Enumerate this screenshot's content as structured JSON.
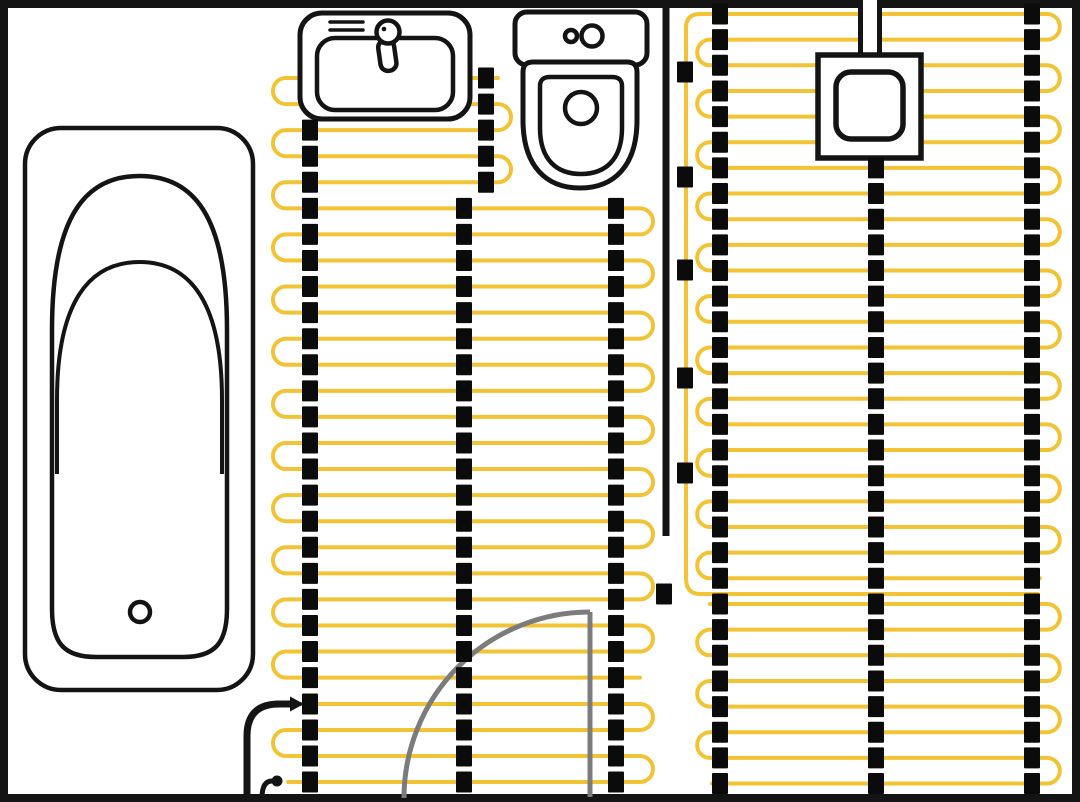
{
  "canvas": {
    "width": 1080,
    "height": 802,
    "background": "#ffffff"
  },
  "palette": {
    "wall": "#141414",
    "cable": "#F2C435",
    "clip": "#0B0B0B",
    "door": "#7C7C7C",
    "fill": "#ffffff"
  },
  "room": {
    "border": {
      "x": 4,
      "y": 4,
      "w": 1072,
      "h": 794,
      "stroke_width": 8
    }
  },
  "interior_wall": {
    "x": 666,
    "y1": 8,
    "y2": 536,
    "stroke_width": 7
  },
  "heating": {
    "cable_stroke_width": 4,
    "zones": {
      "leftUpper": {
        "y0": 78,
        "step": 26.07,
        "count": 24,
        "leftX": 286,
        "rightX": 640,
        "rightShortX": 498,
        "shortRows": 5,
        "firstTurn": "left",
        "startX": 498,
        "endX": 640
      },
      "leftPower": {
        "y0": 704,
        "step": 26,
        "count": 4,
        "leftX": 286,
        "rightX": 640,
        "firstTurn": "right",
        "startX": 300,
        "endX": 288
      },
      "rightUpper": {
        "y0": 14,
        "step": 25.65,
        "count": 23,
        "leftX": 710,
        "rightX": 1047,
        "firstTurn": "right",
        "startX": 700,
        "endX": 1040
      },
      "rightLower": {
        "y0": 604,
        "step": 25.65,
        "count": 8,
        "leftX": 710,
        "rightX": 1047,
        "firstTurn": "right",
        "startX": 710,
        "endX": 712
      }
    },
    "feed": {
      "x": 686,
      "topY": 28,
      "topRowY": 14,
      "topRowX": 700,
      "bottomY": 578,
      "returnY": 594,
      "returnEndX": 1038
    },
    "clip": {
      "w": 16,
      "h": 21
    },
    "clip_columns": [
      {
        "x": 310,
        "rows": [
          [
            "leftUpper",
            2,
            23
          ],
          [
            "leftPower",
            0,
            3
          ]
        ]
      },
      {
        "x": 486,
        "rows": [
          [
            "leftUpper",
            0,
            4
          ]
        ]
      },
      {
        "x": 464,
        "rows": [
          [
            "leftUpper",
            5,
            23
          ],
          [
            "leftPower",
            0,
            3
          ]
        ]
      },
      {
        "x": 616,
        "rows": [
          [
            "leftUpper",
            5,
            23
          ],
          [
            "leftPower",
            0,
            3
          ]
        ]
      },
      {
        "x": 720,
        "rows": [
          [
            "rightUpper",
            0,
            22
          ],
          [
            "rightLower",
            0,
            7
          ]
        ]
      },
      {
        "x": 876,
        "rows": [
          [
            "rightUpper",
            6,
            22
          ],
          [
            "rightLower",
            0,
            7
          ]
        ]
      },
      {
        "x": 1032,
        "rows": [
          [
            "rightUpper",
            0,
            22
          ],
          [
            "rightLower",
            0,
            7
          ]
        ]
      },
      {
        "x": 685,
        "ys": [
          72,
          177,
          270,
          378,
          473
        ]
      },
      {
        "x": 664,
        "ys": [
          594
        ]
      }
    ]
  },
  "fixtures": {
    "bathtub": {
      "outer": {
        "x": 25,
        "y": 128,
        "w": 228,
        "h": 562,
        "rx": 36
      },
      "basin_path": "M52,609 L52,330 C52,215 86,176 139.5,176 C193,176 227,215 227,330 L227,609 C227,645 213,657 183,657 L96,657 C66,657 52,645 52,609 Z",
      "rim_path": "M57,474 L57,400 C57,302 89,262 139.5,262 C190,262 222,302 222,400 L222,474",
      "drain": {
        "cx": 140,
        "cy": 612,
        "r": 10
      },
      "stroke_width": 4.5
    },
    "sink": {
      "outer": {
        "x": 300,
        "y": 13,
        "w": 170,
        "h": 106,
        "rx": 22
      },
      "basin": {
        "x": 317,
        "y": 38,
        "w": 136,
        "h": 72,
        "rx": 18
      },
      "detail_lines": [
        [
          330,
          22,
          363,
          22
        ],
        [
          330,
          30,
          363,
          30
        ]
      ],
      "faucet": {
        "head": {
          "cx": 388,
          "cy": 32,
          "r": 11.5
        },
        "dot": {
          "cx": 384,
          "cy": 29,
          "r": 2.3
        },
        "handle": {
          "x": 378,
          "y": 40,
          "w": 16,
          "h": 31,
          "rx": 7.5,
          "rotate": -8,
          "cx": 386,
          "cy": 46
        }
      },
      "stroke_width": 5
    },
    "toilet": {
      "cistern": {
        "x": 515,
        "y": 12,
        "w": 132,
        "h": 53,
        "rx": 12
      },
      "buttons": [
        {
          "cx": 571,
          "cy": 36,
          "r": 6
        },
        {
          "cx": 592,
          "cy": 36,
          "r": 10.5
        }
      ],
      "bowl_path": "M523,72 Q523,62 533,62 L627,62 Q637,62 637,72 L637,120 C637,166 614,188 580,188 C546,188 523,166 523,120 Z",
      "seat_path": "M540,86 Q540,77 550,77 L612,77 Q622,77 622,86 L622,128 C622,160 605,174 581,174 C557,174 540,160 540,128 Z",
      "flush": {
        "cx": 581,
        "cy": 108,
        "r": 16
      },
      "stroke_width": 5
    },
    "thermostat": {
      "stem": {
        "x": 858,
        "y": 0,
        "w": 24,
        "h": 57
      },
      "box": {
        "x": 818,
        "y": 55,
        "w": 103,
        "h": 103
      },
      "dial": {
        "x": 836,
        "y": 72,
        "w": 67,
        "h": 67,
        "rx": 15
      },
      "stroke_width": 5.5
    },
    "door": {
      "leaf_path": "M590,612 L590,797",
      "arc_path": "M590,612 A186,186 0 0 0 404,798",
      "stroke_width": 5
    },
    "power_lead": {
      "path": "M247,798 L247,736 Q247,704 279,704 L290,704",
      "arrow": [
        [
          290,
          696.5
        ],
        [
          304,
          704
        ],
        [
          290,
          711.5
        ]
      ],
      "stroke_width": 7
    },
    "floor_sensor": {
      "path": "M262,798 C262,787 265,781 272,781",
      "dot": {
        "cx": 277,
        "cy": 781,
        "r": 5.5
      },
      "stroke_width": 5
    }
  }
}
